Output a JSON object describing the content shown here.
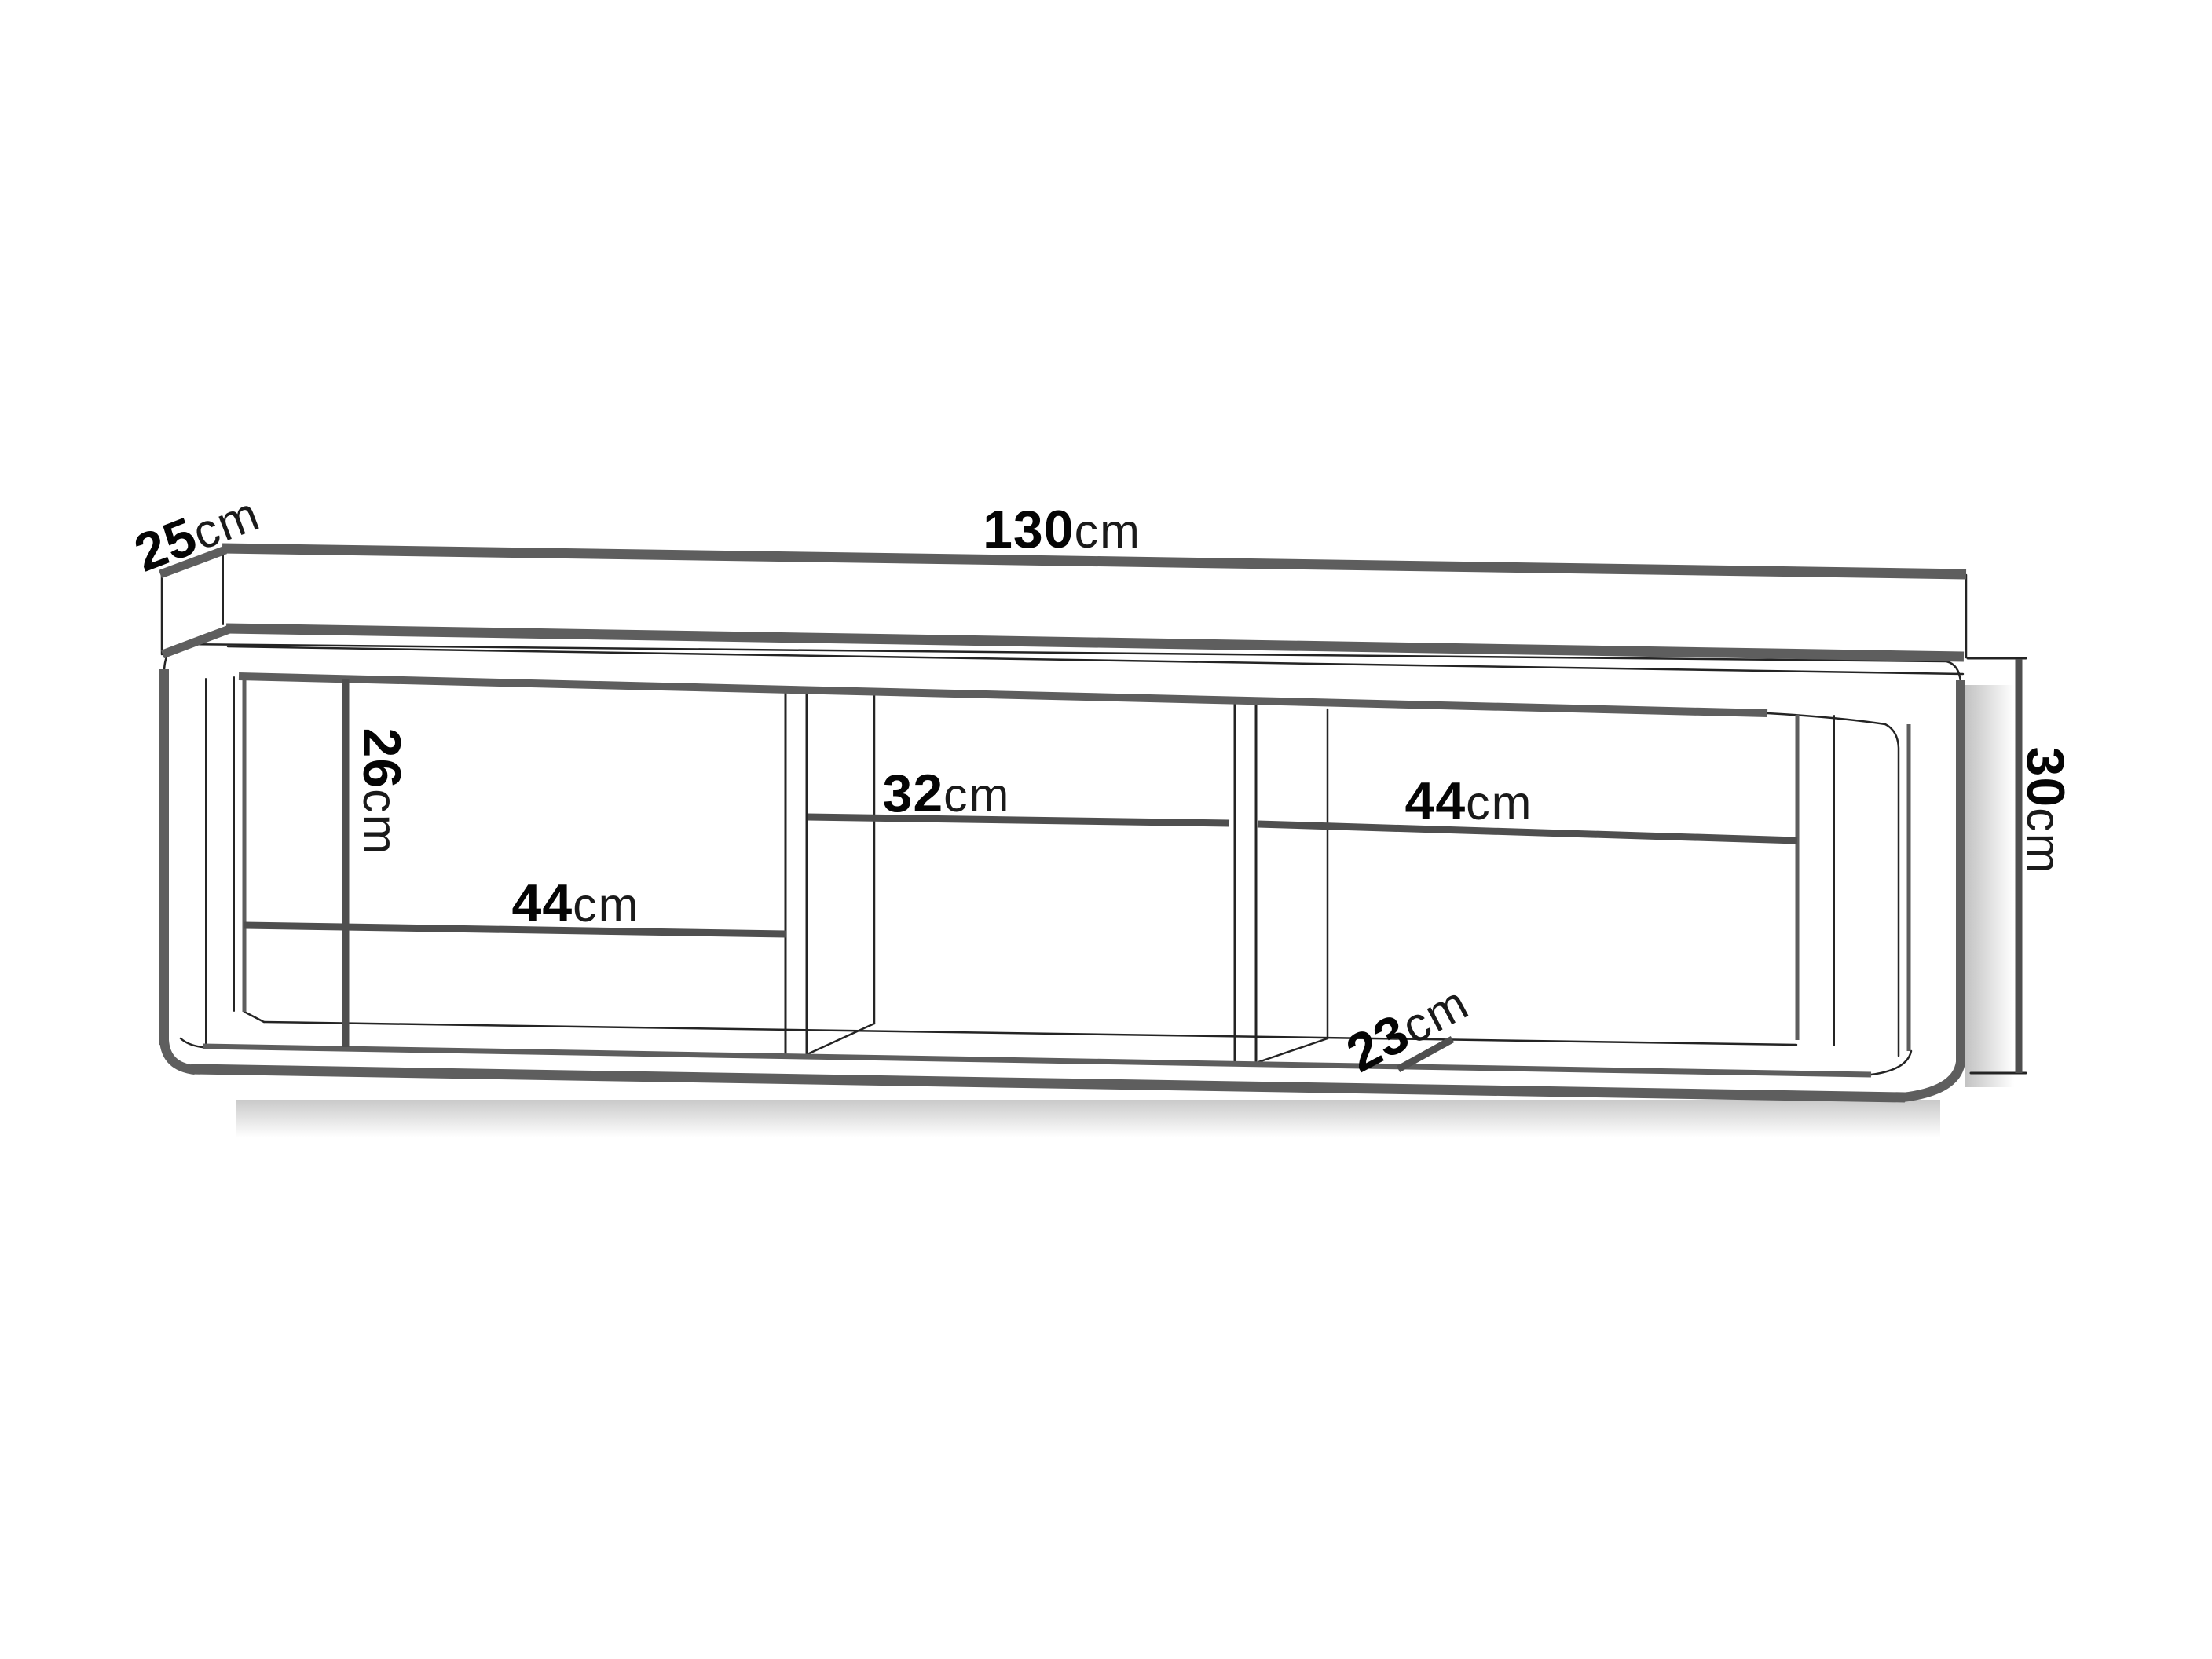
{
  "figure": {
    "type": "furniture-dimension-diagram",
    "subject": "wall-mounted cabinet with three open compartments"
  },
  "dimensions": {
    "depth_top": {
      "value": "25",
      "unit": "cm"
    },
    "width_total": {
      "value": "130",
      "unit": "cm"
    },
    "height_total": {
      "value": "30",
      "unit": "cm"
    },
    "height_interior": {
      "value": "26",
      "unit": "cm"
    },
    "width_left_compartment": {
      "value": "44",
      "unit": "cm"
    },
    "width_middle_compartment": {
      "value": "32",
      "unit": "cm"
    },
    "width_right_compartment": {
      "value": "44",
      "unit": "cm"
    },
    "depth_interior": {
      "value": "23",
      "unit": "cm"
    }
  },
  "colors": {
    "background": "#ffffff",
    "structure_line": "#5e5e5e",
    "dimension_line": "#4f4f4f",
    "thin_line": "#242424",
    "label_text": "#000000"
  }
}
